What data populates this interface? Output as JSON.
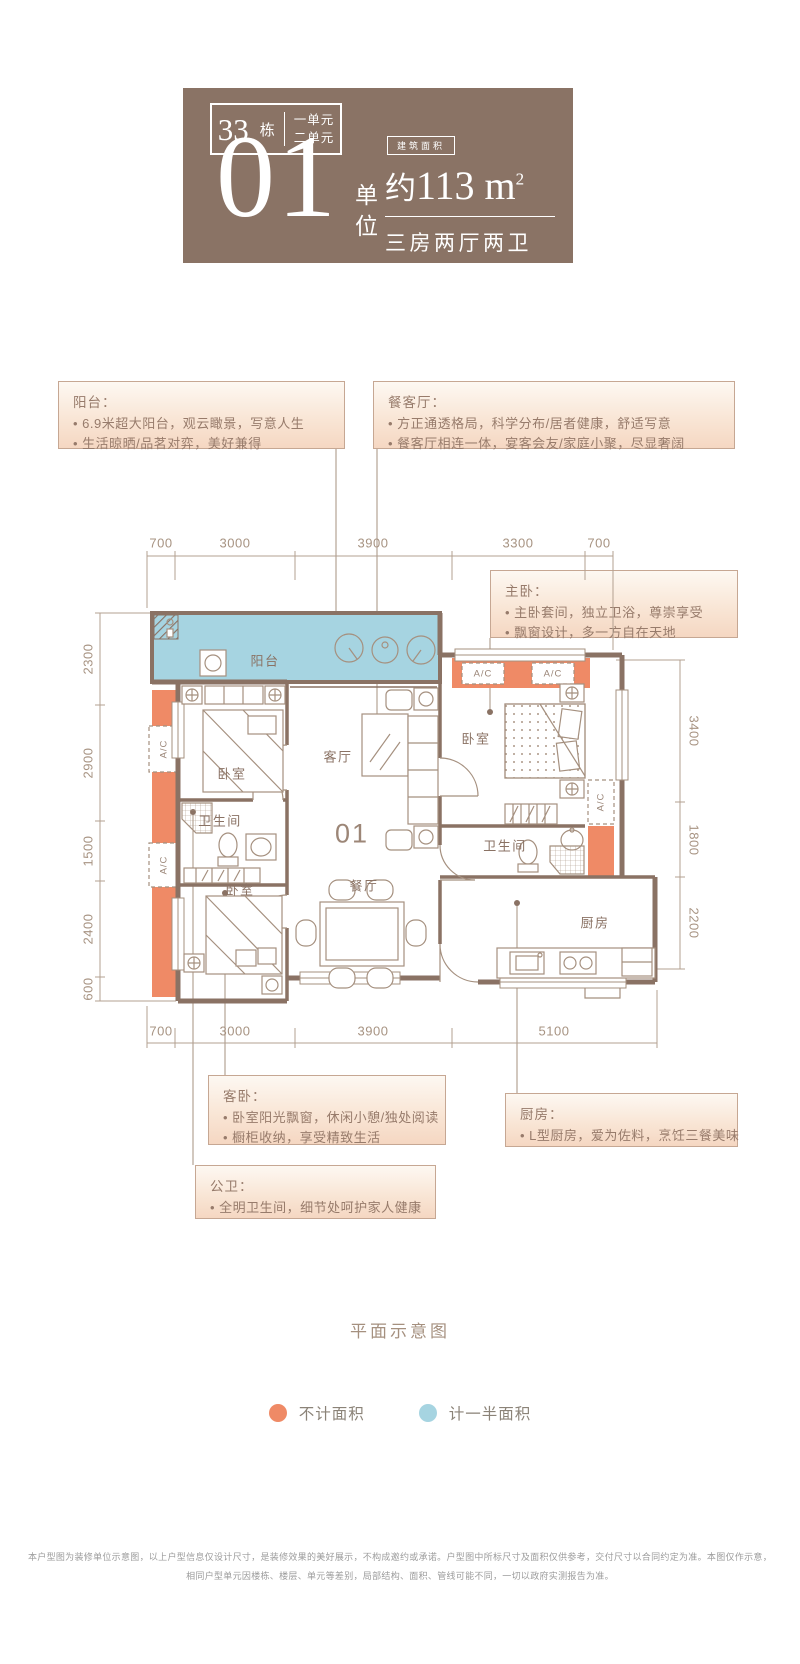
{
  "header": {
    "building_number": "33",
    "building_suffix": "栋",
    "unit_lines": [
      "一单元",
      "二单元"
    ],
    "big_number": "01",
    "big_number_label_chars": [
      "单",
      "位"
    ],
    "area_badge": "建筑面积",
    "area_prefix": "约",
    "area_value": "113 m",
    "area_sup": "2",
    "layout_text": "三房两厅两卫"
  },
  "callouts": {
    "balcony": {
      "title": "阳台：",
      "bullets": [
        "6.9米超大阳台，观云瞰景，写意人生",
        "生活晾晒/品茗对弈，美好兼得"
      ]
    },
    "dining_living": {
      "title": "餐客厅：",
      "bullets": [
        "方正通透格局，科学分布/居者健康，舒适写意",
        "餐客厅相连一体，宴客会友/家庭小聚，尽显奢阔"
      ]
    },
    "master": {
      "title": "主卧：",
      "bullets": [
        "主卧套间，独立卫浴，尊崇享受",
        "飘窗设计，多一方自在天地"
      ]
    },
    "guest": {
      "title": "客卧：",
      "bullets": [
        "卧室阳光飘窗，休闲小憩/独处阅读",
        "橱柜收纳，享受精致生活"
      ]
    },
    "kitchen": {
      "title": "厨房：",
      "bullets": [
        "L型厨房，爱为佐料，烹饪三餐美味"
      ]
    },
    "public_bath": {
      "title": "公卫：",
      "bullets": [
        "全明卫生间，细节处呵护家人健康"
      ]
    }
  },
  "plan": {
    "unit_label": "01",
    "ac_label": "A/C",
    "rooms": {
      "balcony": "阳台",
      "bedroom_tl": "卧室",
      "living": "客厅",
      "bedroom_master": "卧室",
      "bath_left": "卫生间",
      "bedroom_bottom": "卧室",
      "dining": "餐厅",
      "bath_right": "卫生间",
      "kitchen": "厨房"
    },
    "dims": {
      "top": [
        "700",
        "3000",
        "3900",
        "3300",
        "700"
      ],
      "bottom": [
        "700",
        "3000",
        "3900",
        "5100"
      ],
      "left": [
        "2300",
        "2900",
        "1500",
        "2400",
        "600"
      ],
      "right": [
        "3400",
        "1800",
        "2200"
      ]
    }
  },
  "caption": "平面示意图",
  "legend": {
    "items": [
      {
        "name": "excluded-area",
        "label": "不计面积",
        "color": "#ef8a66"
      },
      {
        "name": "half-area",
        "label": "计一半面积",
        "color": "#a6d4e1"
      }
    ]
  },
  "disclaimer": {
    "lines": [
      "本户型图为装修单位示意图，以上户型信息仅设计尺寸，是装修效果的美好展示，不构成邀约或承诺。户型图中所标尺寸及面积仅供参考，交付尺寸以合同约定为准。本图仅作示意，",
      "相同户型单元因楼栋、楼层、单元等差别，局部结构、面积、管线可能不同，一切以政府实测报告为准。"
    ]
  },
  "colors": {
    "brand_brown": "#8a7365",
    "accent_orange": "#ef8a66",
    "accent_blue": "#a6d4e1"
  }
}
